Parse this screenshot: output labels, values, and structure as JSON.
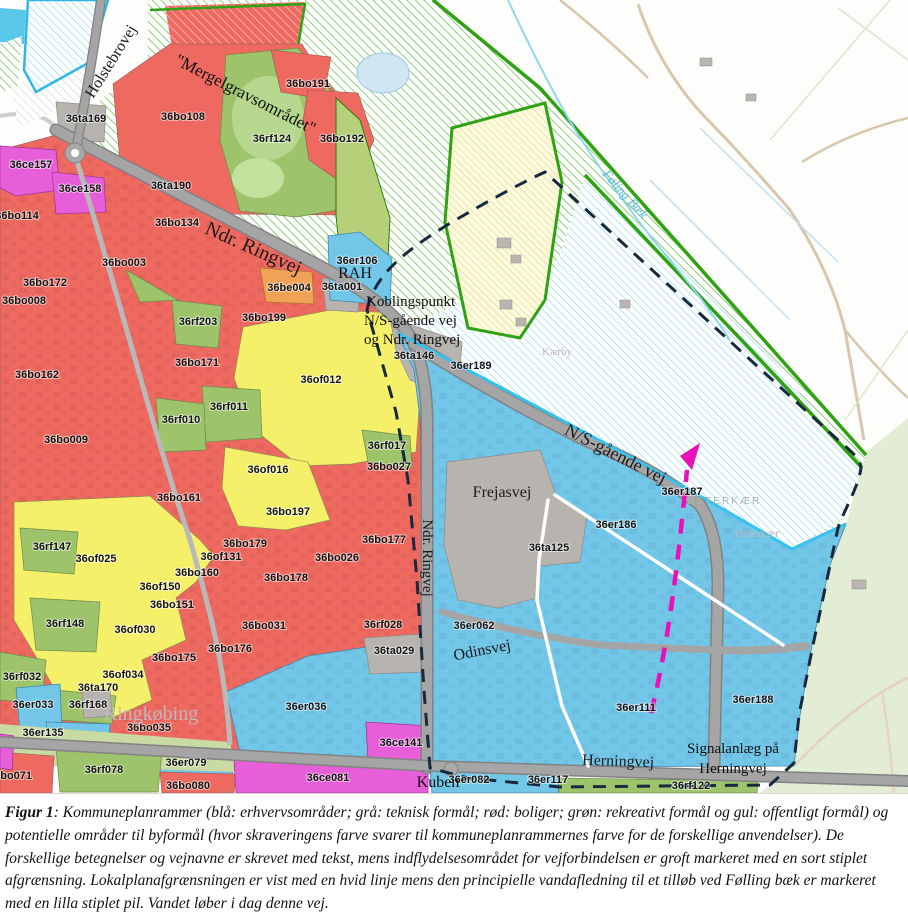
{
  "caption": {
    "prefix": "Figur 1",
    "rest": ": Kommuneplanrammer (blå: erhvervsområder; grå: teknisk formål; rød: boliger; grøn: rekreativt formål og gul: offentligt formål) og potentielle områder til byformål (hvor skraveringens farve svarer til kommuneplanrammernes farve for de forskellige anvendelser). De forskellige betegnelser og vejnavne er skrevet med tekst, mens indflydelsesområdet for vejforbindelsen er groft markeret med en sort stiplet afgrænsning. Lokalplanafgrænsningen er vist med en hvid linje mens den principielle vandafledning til et tilløb ved Følling bæk er markeret med en lilla stiplet pil. Vandet løber i dag denne vej."
  },
  "colors": {
    "erhverv_blue": "#72c7e9",
    "teknisk_grey": "#b7b4b0",
    "bolig_red": "#ee6a61",
    "rekreativ_green": "#9dc46b",
    "offentlig_yellow": "#f4f06a",
    "centerformaal_magenta": "#e65fd8",
    "blandet_orange": "#f0a356",
    "potential_green_hatch": "#53b833",
    "potential_blue_hatch": "#7ad2ee",
    "boundary_dashed": "#17293e",
    "lokalplan_line": "#ffffff",
    "vandafledning_arrow": "#ea10b8",
    "stream_blue": "#8ed8ea"
  },
  "map": {
    "labels": [
      {
        "t": "36ta169",
        "x": 86,
        "y": 122
      },
      {
        "t": "36bo108",
        "x": 183,
        "y": 120
      },
      {
        "t": "36rf124",
        "x": 272,
        "y": 142
      },
      {
        "t": "36bo191",
        "x": 308,
        "y": 87
      },
      {
        "t": "36bo192",
        "x": 342,
        "y": 142
      },
      {
        "t": "36ce157",
        "x": 31,
        "y": 168
      },
      {
        "t": "36ce158",
        "x": 80,
        "y": 192
      },
      {
        "t": "36bo114",
        "x": 17,
        "y": 219
      },
      {
        "t": "36ta190",
        "x": 171,
        "y": 189
      },
      {
        "t": "36bo134",
        "x": 177,
        "y": 226
      },
      {
        "t": "36bo003",
        "x": 124,
        "y": 266
      },
      {
        "t": "36bo172",
        "x": 45,
        "y": 286
      },
      {
        "t": "36er106",
        "x": 357,
        "y": 264
      },
      {
        "t": "36ta001",
        "x": 342,
        "y": 290
      },
      {
        "t": "36be004",
        "x": 289,
        "y": 291
      },
      {
        "t": "36bo008",
        "x": 24,
        "y": 304
      },
      {
        "t": "36rf203",
        "x": 198,
        "y": 325
      },
      {
        "t": "36bo199",
        "x": 264,
        "y": 321
      },
      {
        "t": "36ta146",
        "x": 414,
        "y": 359
      },
      {
        "t": "36er189",
        "x": 471,
        "y": 369
      },
      {
        "t": "36bo171",
        "x": 197,
        "y": 366
      },
      {
        "t": "36bo162",
        "x": 37,
        "y": 378
      },
      {
        "t": "36of012",
        "x": 321,
        "y": 383
      },
      {
        "t": "36rf011",
        "x": 229,
        "y": 410
      },
      {
        "t": "36rf010",
        "x": 181,
        "y": 423
      },
      {
        "t": "36bo009",
        "x": 66,
        "y": 443
      },
      {
        "t": "36of016",
        "x": 268,
        "y": 473
      },
      {
        "t": "36rf017",
        "x": 387,
        "y": 449
      },
      {
        "t": "36bo027",
        "x": 389,
        "y": 470
      },
      {
        "t": "36bo161",
        "x": 179,
        "y": 501
      },
      {
        "t": "36bo197",
        "x": 288,
        "y": 515
      },
      {
        "t": "36bo177",
        "x": 384,
        "y": 543
      },
      {
        "t": "36rf147",
        "x": 52,
        "y": 550
      },
      {
        "t": "36of025",
        "x": 96,
        "y": 562
      },
      {
        "t": "36bo179",
        "x": 245,
        "y": 547
      },
      {
        "t": "36of131",
        "x": 221,
        "y": 560
      },
      {
        "t": "36bo026",
        "x": 337,
        "y": 561
      },
      {
        "t": "36bo160",
        "x": 197,
        "y": 576
      },
      {
        "t": "36bo178",
        "x": 286,
        "y": 581
      },
      {
        "t": "36of150",
        "x": 160,
        "y": 590
      },
      {
        "t": "36bo151",
        "x": 172,
        "y": 608
      },
      {
        "t": "36rf148",
        "x": 65,
        "y": 627
      },
      {
        "t": "36of030",
        "x": 135,
        "y": 633
      },
      {
        "t": "36bo031",
        "x": 264,
        "y": 629
      },
      {
        "t": "36rf028",
        "x": 383,
        "y": 628
      },
      {
        "t": "36bo176",
        "x": 230,
        "y": 652
      },
      {
        "t": "36bo175",
        "x": 174,
        "y": 661
      },
      {
        "t": "36ta029",
        "x": 394,
        "y": 654
      },
      {
        "t": "36rf032",
        "x": 22,
        "y": 680
      },
      {
        "t": "36of034",
        "x": 123,
        "y": 678
      },
      {
        "t": "36ta170",
        "x": 98,
        "y": 691
      },
      {
        "t": "36er033",
        "x": 33,
        "y": 708
      },
      {
        "t": "36rf168",
        "x": 88,
        "y": 708
      },
      {
        "t": "36bo035",
        "x": 149,
        "y": 731
      },
      {
        "t": "36er135",
        "x": 43,
        "y": 736
      },
      {
        "t": "36er036",
        "x": 306,
        "y": 710
      },
      {
        "t": "36ce141",
        "x": 401,
        "y": 746
      },
      {
        "t": "36bo071",
        "x": 10,
        "y": 779
      },
      {
        "t": "36rf078",
        "x": 104,
        "y": 773
      },
      {
        "t": "36er079",
        "x": 186,
        "y": 766
      },
      {
        "t": "36bo080",
        "x": 188,
        "y": 789
      },
      {
        "t": "36ce081",
        "x": 328,
        "y": 781
      },
      {
        "t": "36er082",
        "x": 469,
        "y": 783
      },
      {
        "t": "36er117",
        "x": 548,
        "y": 783
      },
      {
        "t": "36rf122",
        "x": 691,
        "y": 789
      },
      {
        "t": "36er062",
        "x": 474,
        "y": 629
      },
      {
        "t": "36ta125",
        "x": 549,
        "y": 551
      },
      {
        "t": "36er186",
        "x": 616,
        "y": 528
      },
      {
        "t": "36er187",
        "x": 682,
        "y": 495
      },
      {
        "t": "36er111",
        "x": 636,
        "y": 711
      },
      {
        "t": "36er188",
        "x": 753,
        "y": 703
      },
      {
        "t": "Holstebrovej",
        "x": 115,
        "y": 64,
        "r": -58,
        "c": "road",
        "s": 16
      },
      {
        "t": "Ndr. Ringvej",
        "x": 251,
        "y": 254,
        "r": 24,
        "c": "road",
        "s": 20
      },
      {
        "t": "Ndr. Ringvej",
        "x": 423,
        "y": 558,
        "r": 90,
        "c": "road",
        "s": 15
      },
      {
        "t": "N/S-gående vej",
        "x": 613,
        "y": 459,
        "r": 27,
        "c": "road",
        "s": 18
      },
      {
        "t": "Frejasvej",
        "x": 502,
        "y": 497,
        "c": "road",
        "s": 16
      },
      {
        "t": "Odinsvej",
        "x": 483,
        "y": 655,
        "r": -11,
        "c": "road",
        "s": 16
      },
      {
        "t": "Herningvej",
        "x": 618,
        "y": 766,
        "r": 2,
        "c": "road",
        "s": 16
      },
      {
        "t": "\"Mergelgravsområdet\"",
        "x": 243,
        "y": 99,
        "r": 27,
        "c": "ann",
        "s": 17
      },
      {
        "t": "RAH",
        "x": 355,
        "y": 278,
        "c": "ann",
        "s": 16
      },
      {
        "t": "Koblingspunkt",
        "x": 366,
        "y": 306,
        "c": "ann",
        "s": 15,
        "a": "start"
      },
      {
        "t": "N/S-gående vej",
        "x": 364,
        "y": 325,
        "c": "ann",
        "s": 15,
        "a": "start"
      },
      {
        "t": "og Ndr. Ringvej",
        "x": 364,
        "y": 344,
        "c": "ann",
        "s": 15,
        "a": "start"
      },
      {
        "t": "Signalanlæg på",
        "x": 733,
        "y": 753,
        "c": "ann",
        "s": 15
      },
      {
        "t": "Herningvej",
        "x": 733,
        "y": 773,
        "c": "ann",
        "s": 15
      },
      {
        "t": "Kuben",
        "x": 438,
        "y": 787,
        "c": "ann",
        "s": 16
      },
      {
        "t": "Ringkøbing",
        "x": 151,
        "y": 720,
        "c": "place",
        "s": 20
      },
      {
        "t": "Kærby",
        "x": 557,
        "y": 355,
        "c": "place",
        "s": 11
      },
      {
        "t": "Østerkær",
        "x": 757,
        "y": 537,
        "c": "place",
        "s": 12
      },
      {
        "t": "ØSTERKÆR",
        "x": 724,
        "y": 504,
        "c": "placecaps",
        "s": 10,
        "ls": 2
      },
      {
        "t": "Føling Bæk",
        "x": 622,
        "y": 197,
        "r": 48,
        "c": "water",
        "s": 13
      }
    ]
  }
}
